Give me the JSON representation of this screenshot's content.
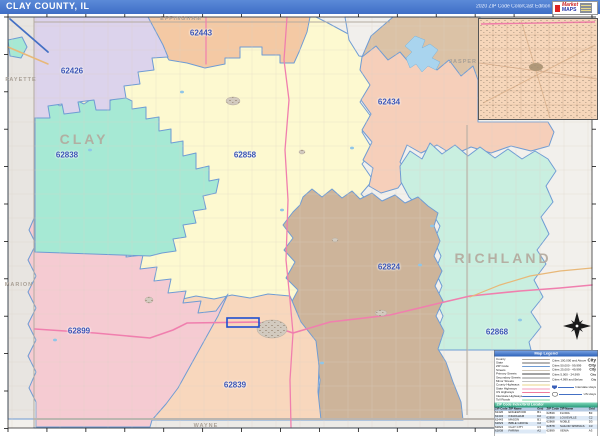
{
  "header": {
    "title": "CLAY COUNTY, IL",
    "edition": "2020 ZIP Code ColorCast Edition",
    "logo": {
      "line1": "Market",
      "line2": "MAPS"
    }
  },
  "map": {
    "zips": [
      {
        "code": "62426",
        "x": 72,
        "y": 57
      },
      {
        "code": "62443",
        "x": 201,
        "y": 19
      },
      {
        "code": "62838",
        "x": 67,
        "y": 141
      },
      {
        "code": "62858",
        "x": 245,
        "y": 141
      },
      {
        "code": "62434",
        "x": 389,
        "y": 88
      },
      {
        "code": "62824",
        "x": 389,
        "y": 253
      },
      {
        "code": "62899",
        "x": 79,
        "y": 317
      },
      {
        "code": "62839",
        "x": 235,
        "y": 371
      },
      {
        "code": "62868",
        "x": 497,
        "y": 318
      }
    ],
    "counties": [
      {
        "name": "CLAY",
        "x": 84,
        "y": 125,
        "cls": "cnty-big"
      },
      {
        "name": "RICHLAND",
        "x": 503,
        "y": 244,
        "cls": "cnty-big"
      },
      {
        "name": "EFFINGHAM",
        "x": 181,
        "y": 5,
        "cls": "cnty-sm"
      },
      {
        "name": "JASPER",
        "x": 463,
        "y": 48,
        "cls": "cnty-sm"
      },
      {
        "name": "FAYETTE",
        "x": 21,
        "y": 66,
        "cls": "cnty-sm"
      },
      {
        "name": "MARION",
        "x": 19,
        "y": 271,
        "cls": "cnty-sm"
      },
      {
        "name": "WAYNE",
        "x": 206,
        "y": 412,
        "cls": "cnty-sm"
      }
    ],
    "region_colors": {
      "base": "#f2f0ec",
      "gray_left": "#e8e5e1",
      "wayne": "#eceae6",
      "z62426": "#dcd3ec",
      "z62838": "#a6e9d4",
      "z62858": "#fdf9d0",
      "z62443": "#f4c9a4",
      "jasper_tan": "#dbc2a6",
      "z62434": "#f6cfba",
      "z62868": "#c9efe0",
      "z62824": "#cdb49a",
      "z62839": "#f8d7bd",
      "z62899": "#f5cbd2",
      "gray_piece": "#f1efec",
      "water": "#a9d4ee",
      "zip_border": "#6f9cd4",
      "county_line": "#b4aba0",
      "road_major": "#f07fae",
      "road_orange": "#e8b878",
      "road_blue": "#4470c4"
    }
  },
  "legend": {
    "title": "Map Legend",
    "rows": [
      {
        "label": "County",
        "color": "#b0a89e"
      },
      {
        "label": "State",
        "color": "#6a6a6a"
      },
      {
        "label": "ZIP Code",
        "color": "#6f9cd4"
      },
      {
        "label": "Streets",
        "color": "#cfc6b8"
      },
      {
        "label": "Primary Streets",
        "color": "#444444"
      },
      {
        "label": "Secondary Streets",
        "color": "#8a8a8a"
      },
      {
        "label": "Minor Streets",
        "color": "#c2c2c2"
      },
      {
        "label": "County Highways",
        "color": "#e8d48a"
      },
      {
        "label": "State Highways",
        "color": "#f59ab8"
      },
      {
        "label": "US Highways",
        "color": "#ef7b9e"
      },
      {
        "label": "Interstate Highways",
        "color": "#4470c4"
      },
      {
        "label": "Toll Roads",
        "color": "#7ed6a0"
      }
    ],
    "city_rows": [
      {
        "label": "Cities 100,000 and Above",
        "sample": "City",
        "size": 9
      },
      {
        "label": "Cities 50,000 - 99,999",
        "sample": "City",
        "size": 8
      },
      {
        "label": "Cities 25,000 - 49,999",
        "sample": "City",
        "size": 7
      },
      {
        "label": "Cities 5,000 - 24,999",
        "sample": "City",
        "size": 6
      },
      {
        "label": "Cities 4,999 and Below",
        "sample": "City",
        "size": 5
      }
    ],
    "highway_samples": [
      {
        "label": "Interstate Hwys",
        "icon": "shield"
      },
      {
        "label": "US Hwys",
        "icon": "oval"
      }
    ]
  },
  "index": {
    "title": "ZIP Code Index/Grid Locator",
    "columns": [
      "ZIP Code",
      "ZIP Name",
      "Grid"
    ],
    "rows_left": [
      {
        "code": "62426",
        "name": "EDGEWOOD",
        "grid": "B1"
      },
      {
        "code": "62434",
        "name": "INGRAHAM",
        "grid": "D2"
      },
      {
        "code": "62443",
        "name": "MASON",
        "grid": "B1"
      },
      {
        "code": "62823",
        "name": "BIBLE GROVE",
        "grid": "C2"
      },
      {
        "code": "62824",
        "name": "CLAY CITY",
        "grid": "C3"
      },
      {
        "code": "62838",
        "name": "FARINA",
        "grid": "A2"
      }
    ],
    "rows_right": [
      {
        "code": "62839",
        "name": "FLORA",
        "grid": "B3"
      },
      {
        "code": "62858",
        "name": "LOUISVILLE",
        "grid": "C2"
      },
      {
        "code": "62868",
        "name": "NOBLE",
        "grid": "D3"
      },
      {
        "code": "62878",
        "name": "SAILOR SPRINGS",
        "grid": "C3"
      },
      {
        "code": "62899",
        "name": "XENIA",
        "grid": "A3"
      }
    ]
  }
}
